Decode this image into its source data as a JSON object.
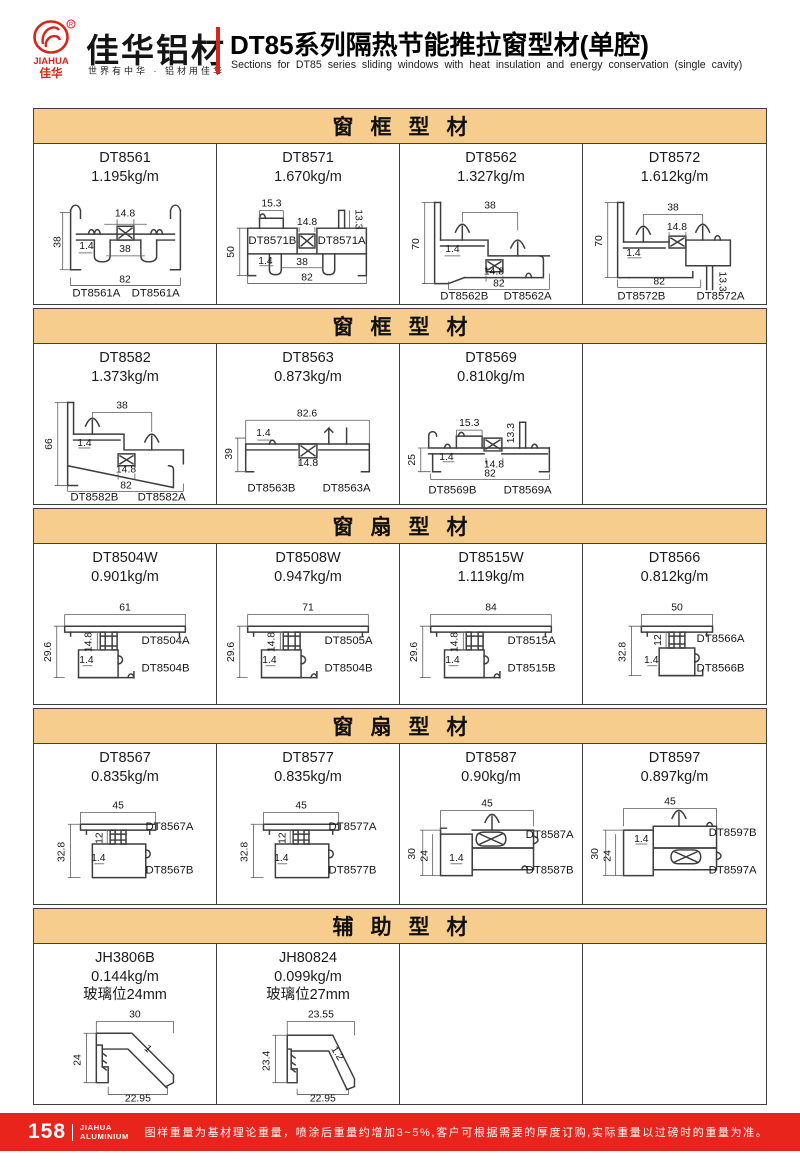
{
  "header": {
    "logo": {
      "brand_en": "JIAHUA",
      "emblem_cn": "佳华",
      "registered": "R",
      "brand_cn": "佳华铝材",
      "tagline": "世界有中华 · 铝材用佳华"
    },
    "title_cn": "DT85系列隔热节能推拉窗型材(单腔)",
    "title_en": "Sections for DT85 series sliding windows with heat insulation and energy conservation (single cavity)"
  },
  "colors": {
    "section_header_bg": "#f7cd8d",
    "brand_red": "#d8251c",
    "footer_red": "#e8241c",
    "line": "#3f3f3f"
  },
  "sections": [
    {
      "title": "窗框型材",
      "cells": [
        {
          "model": "DT8561",
          "weight": "1.195kg/m",
          "shape": "t8561",
          "dims": [
            "14.8",
            "38",
            "1.4",
            "38",
            "82"
          ],
          "parts": [
            "DT8561A",
            "DT8561A"
          ]
        },
        {
          "model": "DT8571",
          "weight": "1.670kg/m",
          "shape": "t8571",
          "dims": [
            "15.3",
            "13.3",
            "14.8",
            "50",
            "1.4",
            "38",
            "82"
          ],
          "parts": [
            "DT8571B",
            "DT8571A"
          ]
        },
        {
          "model": "DT8562",
          "weight": "1.327kg/m",
          "shape": "t8562",
          "dims": [
            "38",
            "70",
            "1.4",
            "14.8",
            "82"
          ],
          "parts": [
            "DT8562B",
            "DT8562A"
          ]
        },
        {
          "model": "DT8572",
          "weight": "1.612kg/m",
          "shape": "t8572",
          "dims": [
            "38",
            "70",
            "14.8",
            "1.4",
            "82",
            "13.3"
          ],
          "parts": [
            "DT8572B",
            "DT8572A"
          ]
        }
      ]
    },
    {
      "title": "窗框型材",
      "cells": [
        {
          "model": "DT8582",
          "weight": "1.373kg/m",
          "shape": "t8582",
          "dims": [
            "38",
            "66",
            "1.4",
            "14.8",
            "82"
          ],
          "parts": [
            "DT8582B",
            "DT8582A"
          ]
        },
        {
          "model": "DT8563",
          "weight": "0.873kg/m",
          "shape": "t8563",
          "dims": [
            "82.6",
            "1.4",
            "39",
            "14.8"
          ],
          "parts": [
            "DT8563B",
            "DT8563A"
          ]
        },
        {
          "model": "DT8569",
          "weight": "0.810kg/m",
          "shape": "t8569",
          "dims": [
            "15.3",
            "13.3",
            "25",
            "1.4",
            "14.8",
            "82"
          ],
          "parts": [
            "DT8569B",
            "DT8569A"
          ]
        },
        null
      ]
    },
    {
      "title": "窗扇型材",
      "cells": [
        {
          "model": "DT8504W",
          "weight": "0.901kg/m",
          "shape": "sashW",
          "dims": [
            "61",
            "14.8",
            "29.6",
            "1.4"
          ],
          "parts": [
            "DT8504A",
            "DT8504B"
          ]
        },
        {
          "model": "DT8508W",
          "weight": "0.947kg/m",
          "shape": "sashW",
          "dims": [
            "71",
            "14.8",
            "29.6",
            "1.4"
          ],
          "parts": [
            "DT8505A",
            "DT8504B"
          ]
        },
        {
          "model": "DT8515W",
          "weight": "1.119kg/m",
          "shape": "sashW",
          "dims": [
            "84",
            "14.8",
            "29.6",
            "1.4"
          ],
          "parts": [
            "DT8515A",
            "DT8515B"
          ]
        },
        {
          "model": "DT8566",
          "weight": "0.812kg/m",
          "shape": "t8566",
          "dims": [
            "50",
            "12",
            "32.8",
            "1.4"
          ],
          "parts": [
            "DT8566A",
            "DT8566B"
          ]
        }
      ]
    },
    {
      "title": "窗扇型材",
      "cells": [
        {
          "model": "DT8567",
          "weight": "0.835kg/m",
          "shape": "sashV",
          "dims": [
            "45",
            "12",
            "32.8",
            "1.4"
          ],
          "parts": [
            "DT8567A",
            "DT8567B"
          ]
        },
        {
          "model": "DT8577",
          "weight": "0.835kg/m",
          "shape": "sashV",
          "dims": [
            "45",
            "12",
            "32.8",
            "1.4"
          ],
          "parts": [
            "DT8577A",
            "DT8577B"
          ]
        },
        {
          "model": "DT8587",
          "weight": "0.90kg/m",
          "shape": "sashH",
          "dims": [
            "45",
            "30",
            "24",
            "1.4"
          ],
          "parts": [
            "DT8587A",
            "DT8587B"
          ]
        },
        {
          "model": "DT8597",
          "weight": "0.897kg/m",
          "shape": "sashH2",
          "dims": [
            "45",
            "30",
            "24",
            "1.4"
          ],
          "parts": [
            "DT8597B",
            "DT8597A"
          ]
        }
      ]
    },
    {
      "title": "辅助型材",
      "cells": [
        {
          "model": "JH3806B",
          "weight": "0.144kg/m",
          "note": "玻璃位24mm",
          "shape": "bead",
          "dims": [
            "30",
            "24",
            "1",
            "22.95"
          ],
          "parts": []
        },
        {
          "model": "JH80824",
          "weight": "0.099kg/m",
          "note": "玻璃位27mm",
          "shape": "bead2",
          "dims": [
            "23.55",
            "23.4",
            "1.2",
            "22.95"
          ],
          "parts": []
        },
        null,
        null
      ]
    }
  ],
  "footer": {
    "page": "158",
    "brand_line1": "JIAHUA",
    "brand_line2": "ALUMINIUM",
    "note": "图样重量为基材理论重量，喷涂后重量约增加3~5%,客户可根据需要的厚度订购,实际重量以过磅时的重量为准。"
  }
}
